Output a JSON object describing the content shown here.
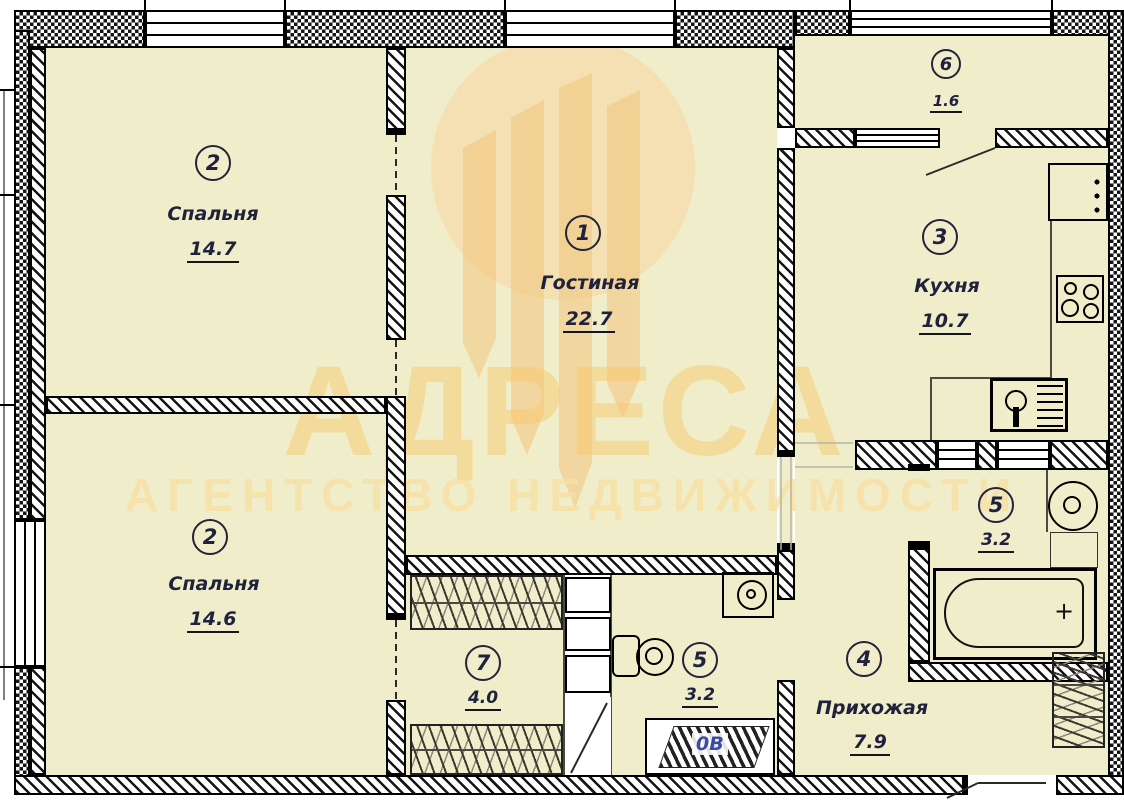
{
  "plan": {
    "watermark": {
      "brand": "АДРЕСА",
      "subtitle": "АГЕНТСТВО НЕДВИЖИМОСТИ"
    },
    "vent_label": "0В",
    "bathtub_plus": "+",
    "rooms": {
      "bedroom_top": {
        "num": "2",
        "name": "Спальня",
        "area": "14.7"
      },
      "living": {
        "num": "1",
        "name": "Гостиная",
        "area": "22.7"
      },
      "kitchen": {
        "num": "3",
        "name": "Кухня",
        "area": "10.7"
      },
      "hall": {
        "num": "4",
        "name": "Прихожая",
        "area": "7.9"
      },
      "bath": {
        "num": "5",
        "area": "3.2"
      },
      "wc": {
        "num": "5",
        "area": "3.2"
      },
      "balcony": {
        "num": "6",
        "area": "1.6"
      },
      "wardrobe": {
        "num": "7",
        "area": "4.0"
      },
      "bedroom_bottom": {
        "num": "2",
        "name": "Спальня",
        "area": "14.6"
      }
    },
    "colors": {
      "room_fill": "#f0eeca",
      "wall_line": "#111111",
      "text": "#20223d",
      "watermark_orange": "#f7c669"
    }
  }
}
